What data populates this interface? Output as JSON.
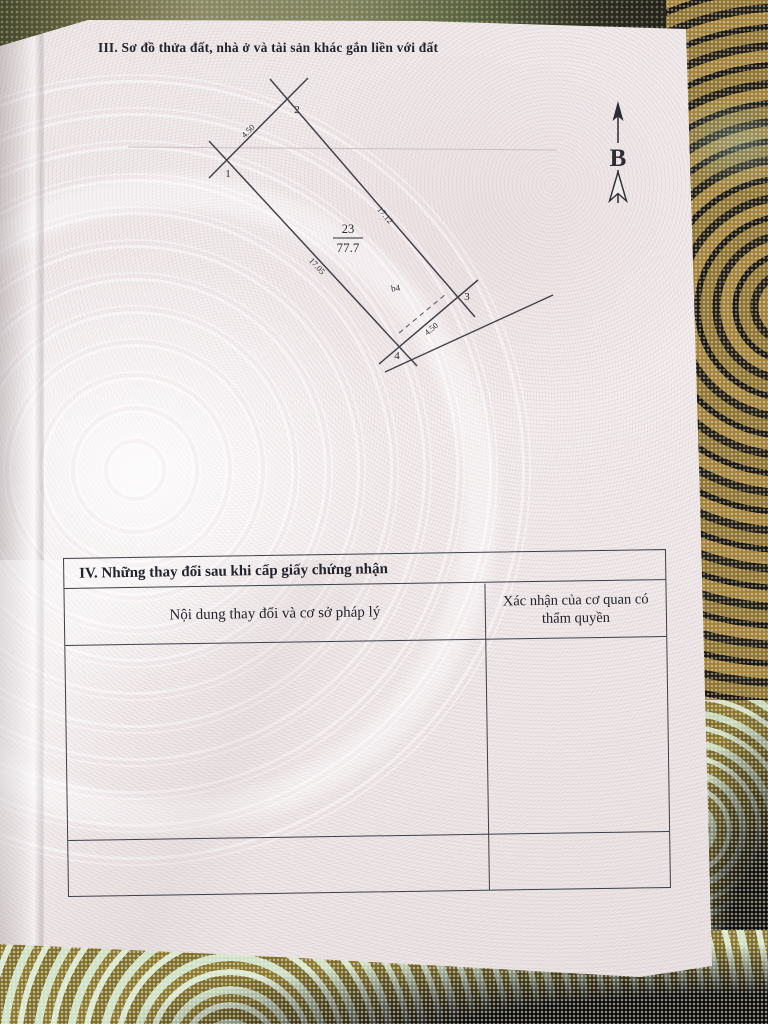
{
  "page": {
    "section3_title": "III. Sơ đồ thửa đất, nhà ở và tài sản khác gắn liền với đất"
  },
  "diagram": {
    "north_label": "B",
    "parcel_number": "23",
    "parcel_area": "77.7",
    "annotation": "b4",
    "vertex_labels": [
      "1",
      "2",
      "3",
      "4"
    ],
    "edge_labels": {
      "top": "4.50",
      "right": "17.12",
      "left": "17.05",
      "bottom": "4.50"
    }
  },
  "table": {
    "section_title": "IV. Những thay đổi sau khi cấp giấy chứng nhận",
    "col1_header": "Nội dung thay đổi và cơ sở pháp lý",
    "col2_header": "Xác nhận của cơ quan có thẩm quyền"
  }
}
